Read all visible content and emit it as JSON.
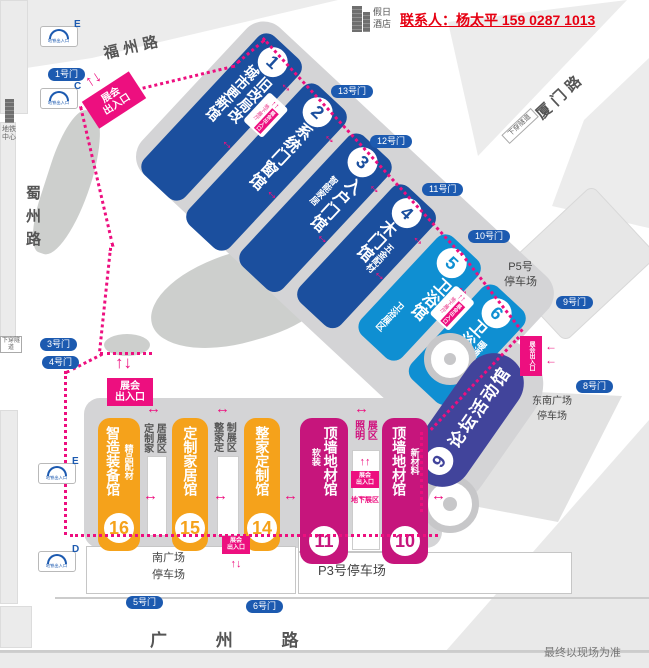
{
  "header": {
    "hotel": {
      "line1": "假日",
      "line2": "酒店"
    },
    "contact": "联系人：杨太平 159 0287 1013"
  },
  "roads": {
    "fuzhou": "福州路",
    "xiamen": "厦门路",
    "shuzhou": "蜀州路",
    "guangzhou": "广 州 路"
  },
  "metro": {
    "center_line1": "地铁",
    "center_line2": "中心",
    "exit_label": "地铁出入口",
    "exits": [
      {
        "letter": "E"
      },
      {
        "letter": "C"
      },
      {
        "letter": "E"
      },
      {
        "letter": "D"
      }
    ]
  },
  "tunnel_label": "下穿隧道",
  "gates": [
    {
      "label": "1号门"
    },
    {
      "label": "3号门"
    },
    {
      "label": "4号门"
    },
    {
      "label": "5号门"
    },
    {
      "label": "6号门"
    },
    {
      "label": "8号门"
    },
    {
      "label": "9号门"
    },
    {
      "label": "10号门"
    },
    {
      "label": "11号门"
    },
    {
      "label": "12号门"
    },
    {
      "label": "13号门"
    }
  ],
  "entrance": {
    "label": "展会出入口",
    "line1": "展会",
    "line2": "出入口",
    "underground_hall": "地下展厅",
    "underground_zone": "地下展区"
  },
  "halls": [
    {
      "num": "1",
      "cols": [
        {
          "text": "城市更新馆"
        },
        {
          "text": "旧改局改"
        }
      ]
    },
    {
      "num": "2",
      "cols": [
        {
          "text": "系统门窗馆"
        }
      ]
    },
    {
      "num": "3",
      "cols": [
        {
          "text": "智能家居"
        },
        {
          "text": "入户门馆"
        }
      ]
    },
    {
      "num": "4",
      "cols": [
        {
          "text": "木门馆"
        },
        {
          "text": "五金配材"
        }
      ]
    },
    {
      "num": "5",
      "cols": [
        {
          "text": "卫浴展区"
        },
        {
          "text": "卫浴馆"
        }
      ]
    },
    {
      "num": "6",
      "cols": [
        {
          "text": "卫浴馆"
        },
        {
          "text": "暖通厨电"
        }
      ]
    },
    {
      "num": "9",
      "cols": [
        {
          "text": "论坛活动馆"
        }
      ]
    },
    {
      "num": "10",
      "cols": [
        {
          "text": "顶墙地材馆"
        },
        {
          "text": "新材料"
        }
      ]
    },
    {
      "num": "11",
      "cols": [
        {
          "text": "软装"
        },
        {
          "text": "顶墙地材馆"
        }
      ]
    },
    {
      "num": "14",
      "cols": [
        {
          "text": "整家定制馆"
        }
      ]
    },
    {
      "num": "15",
      "cols": [
        {
          "text": "定制家居馆"
        }
      ]
    },
    {
      "num": "16",
      "cols": [
        {
          "text": "智造装备馆"
        },
        {
          "text": "精品配材"
        }
      ]
    }
  ],
  "zones": [
    {
      "col1": "定制家",
      "col2": "居展区"
    },
    {
      "col1": "整家定",
      "col2": "制展区"
    },
    {
      "col1": "照明",
      "col2": "展区"
    }
  ],
  "parking": {
    "p5_line1": "P5号",
    "p5_line2": "停车场",
    "southeast_line1": "东南广场",
    "southeast_line2": "停车场",
    "p3": "P3号停车场",
    "south_line1": "南广场",
    "south_line2": "停车场"
  },
  "footnote": "最终以现场为准",
  "colors": {
    "dark_blue": "#1b4f9e",
    "light_blue": "#0f8fd2",
    "indigo": "#41449b",
    "magenta_hall": "#c6157c",
    "orange": "#f5a21b",
    "accent_magenta": "#ed0f7f",
    "gate_blue": "#1c5ab0",
    "contact_red": "#e60012"
  }
}
